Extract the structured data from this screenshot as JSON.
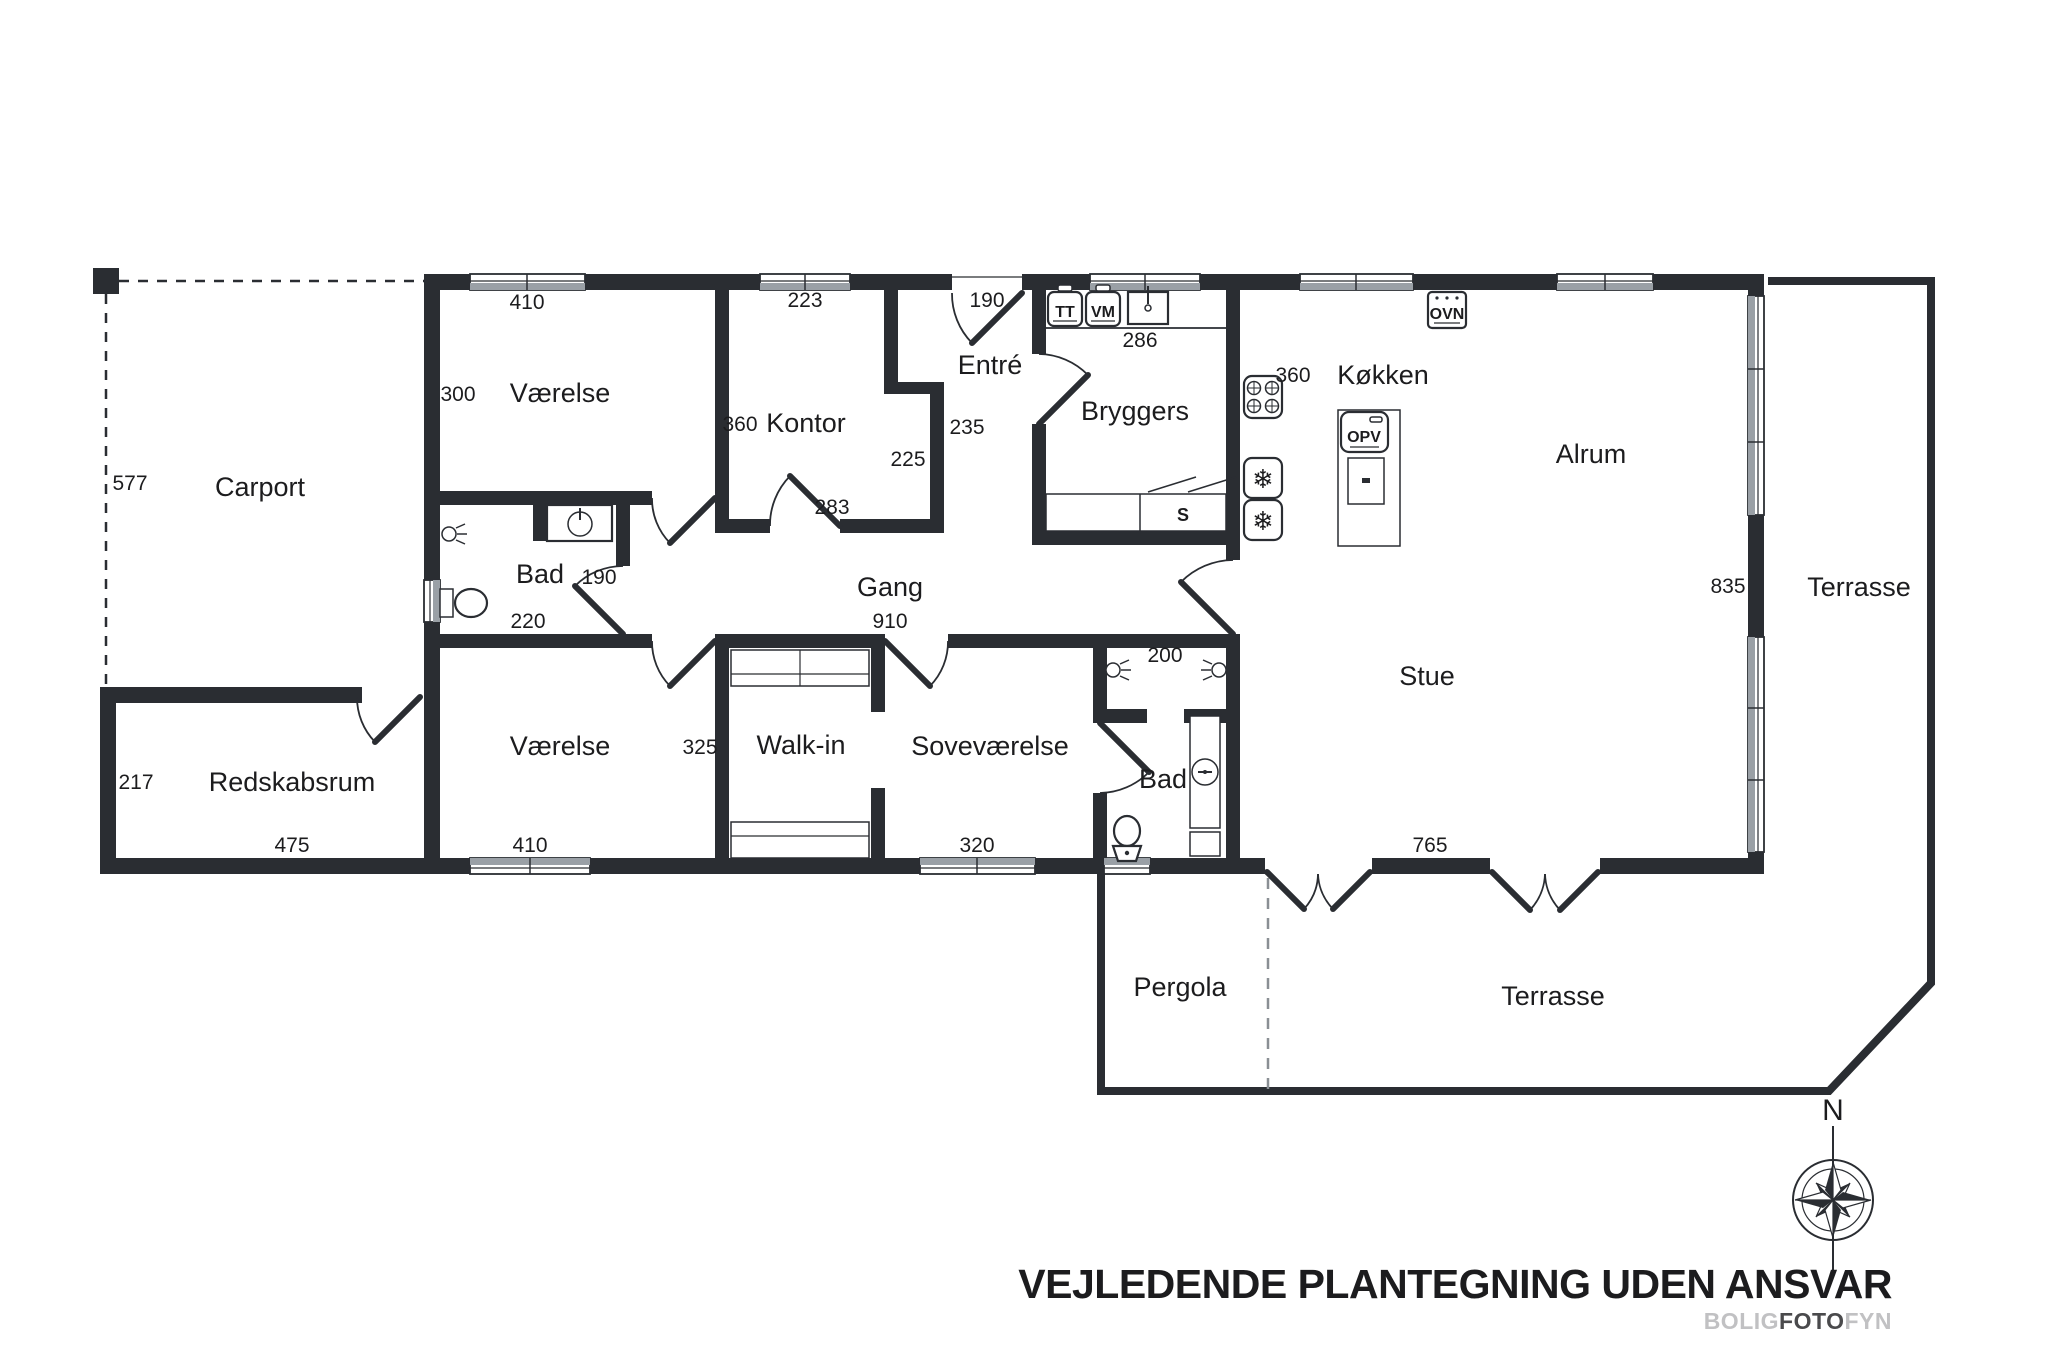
{
  "plan": {
    "rooms": {
      "carport": "Carport",
      "redskabsrum": "Redskabsrum",
      "vaerelse_top": "Værelse",
      "kontor": "Kontor",
      "entre": "Entré",
      "bryggers": "Bryggers",
      "koekken": "Køkken",
      "alrum": "Alrum",
      "stue": "Stue",
      "gang": "Gang",
      "bad_left": "Bad",
      "vaerelse_bottom": "Værelse",
      "walkin": "Walk-in",
      "sovevaerelse": "Soveværelse",
      "bad_bottom": "Bad",
      "pergola": "Pergola",
      "terrasse_east": "Terrasse",
      "terrasse_south": "Terrasse"
    },
    "dimensions": {
      "carport_depth": "577",
      "vaerelse_top_width": "410",
      "vaerelse_top_depth": "300",
      "kontor_width": "223",
      "entry_door": "190",
      "kontor_depth": "360",
      "entre_depth": "235",
      "kontor_lower": "225",
      "kontor_south": "283",
      "bryggers_counter": "286",
      "koekken_depth": "360",
      "east_wall": "835",
      "bad_left_door": "190",
      "bad_left_width": "220",
      "gang_length": "910",
      "bad_bottom_width": "200",
      "redskabsrum_depth": "217",
      "redskabsrum_width": "475",
      "vaerelse_bottom_width": "410",
      "walkin_width": "325",
      "sovevaerelse_width": "320",
      "stue_width": "765"
    },
    "appliances": {
      "tt": "TT",
      "vm": "VM",
      "ovn": "OVN",
      "opv": "OPV",
      "closet": "S"
    },
    "compass": {
      "north": "N"
    },
    "icons": {
      "snowflake": "❄"
    },
    "footer": {
      "title": "VEJLEDENDE PLANTEGNING UDEN ANSVAR",
      "logo_bolig": "BOLIG",
      "logo_foto": "FOTO",
      "logo_fyn": "FYN"
    }
  }
}
